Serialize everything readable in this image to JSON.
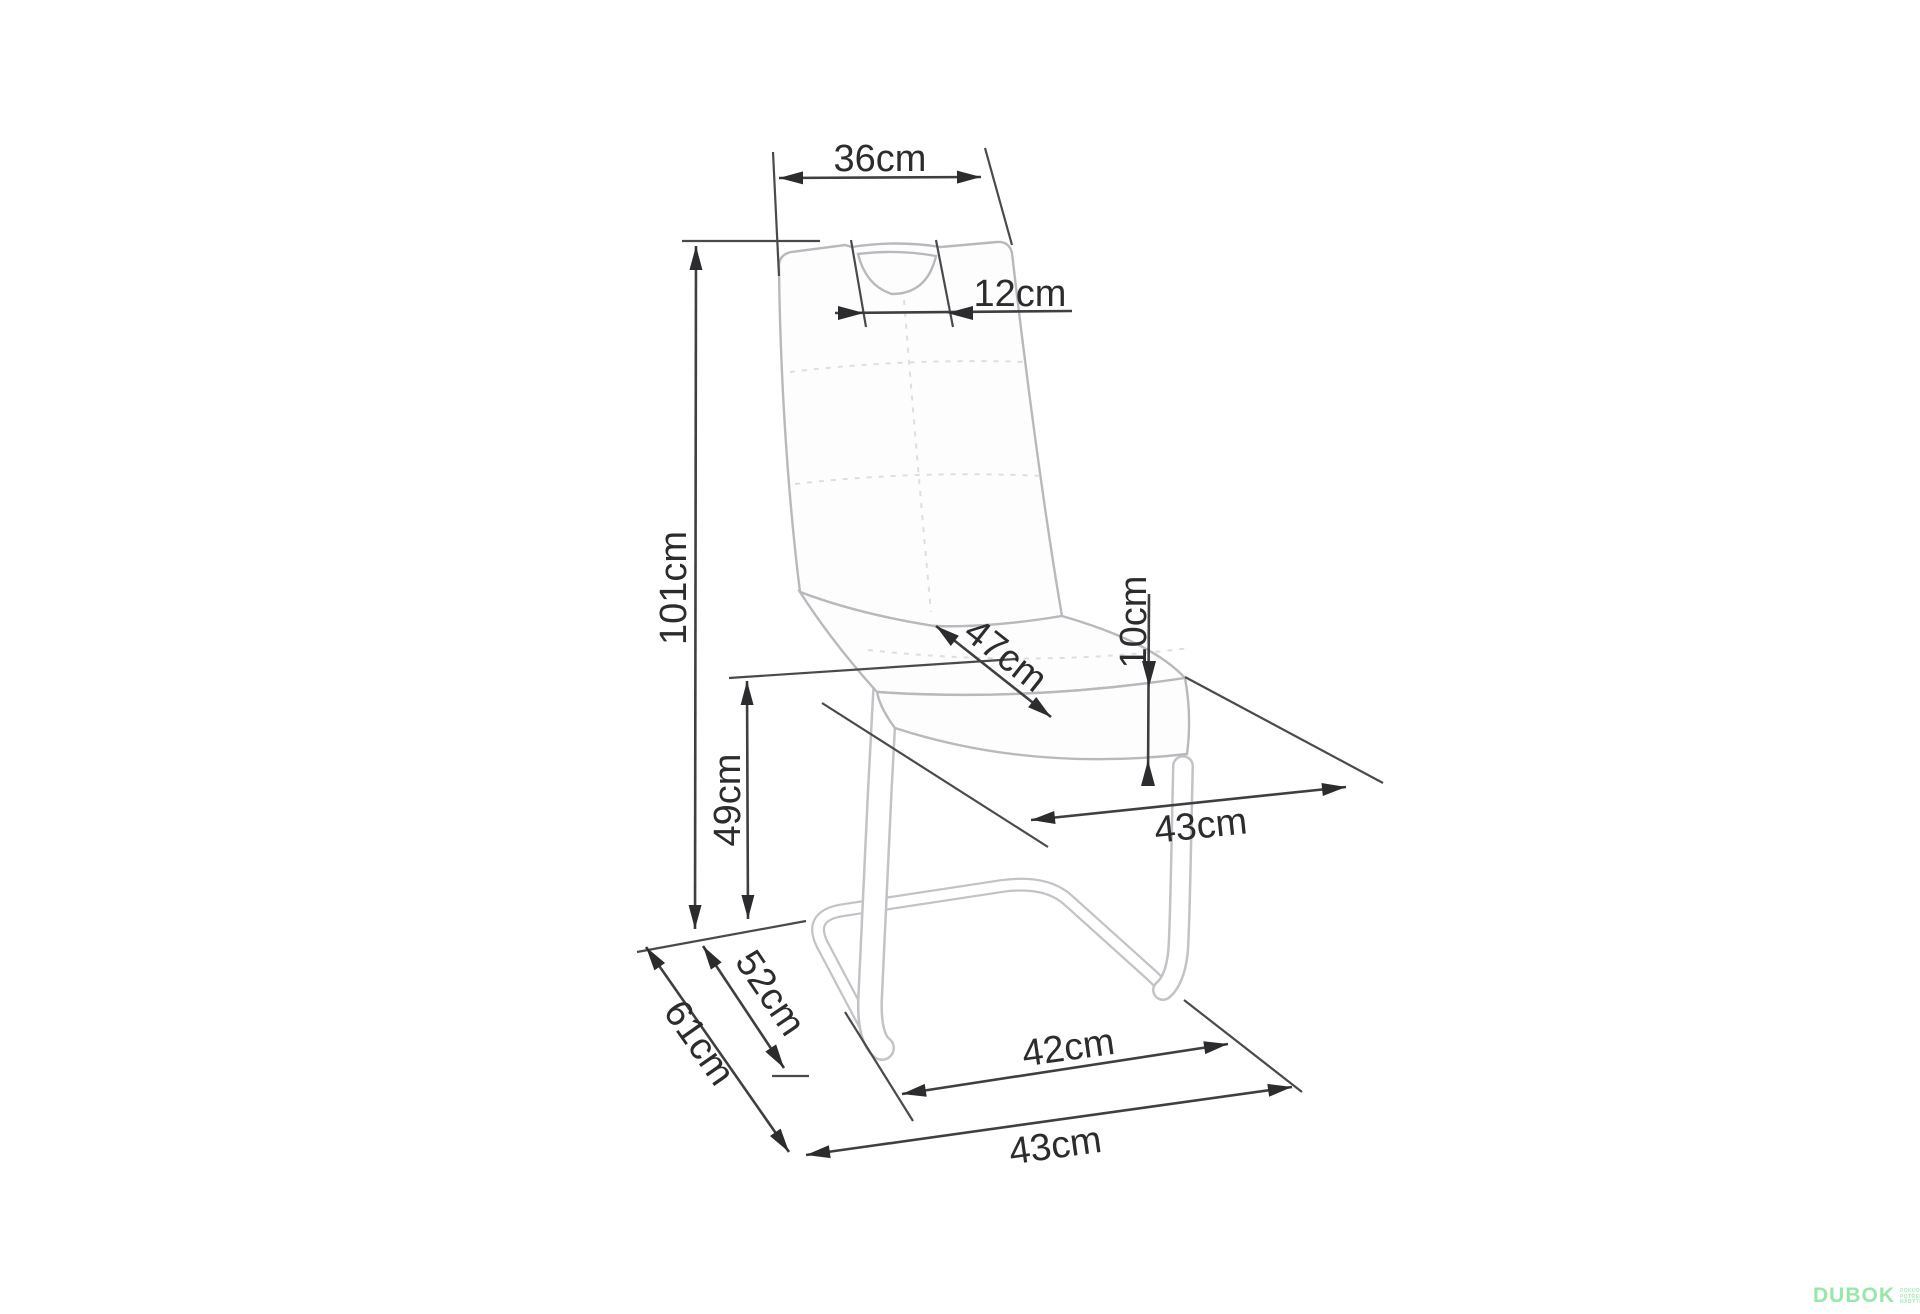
{
  "diagram": {
    "kind": "chair dimension drawing",
    "line_color": "#3f3f41",
    "chair_outline_color": "#b9b9bd"
  },
  "dims": {
    "backrest_top_width": "36cm",
    "handle_width": "12cm",
    "total_height": "101cm",
    "seat_height": "49cm",
    "seat_depth": "47cm",
    "seat_thickness": "10cm",
    "seat_width": "43cm",
    "base_runner_length": "52cm",
    "base_total_depth": "61cm",
    "base_inner_width": "42cm",
    "base_total_width": "43cm"
  },
  "watermark": {
    "brand": "DUBOK",
    "brand_color": "#98e7a8",
    "tagline_lines": [
      "POKUD",
      "POTŘEBUJETE",
      "NÁBYTEK"
    ]
  }
}
